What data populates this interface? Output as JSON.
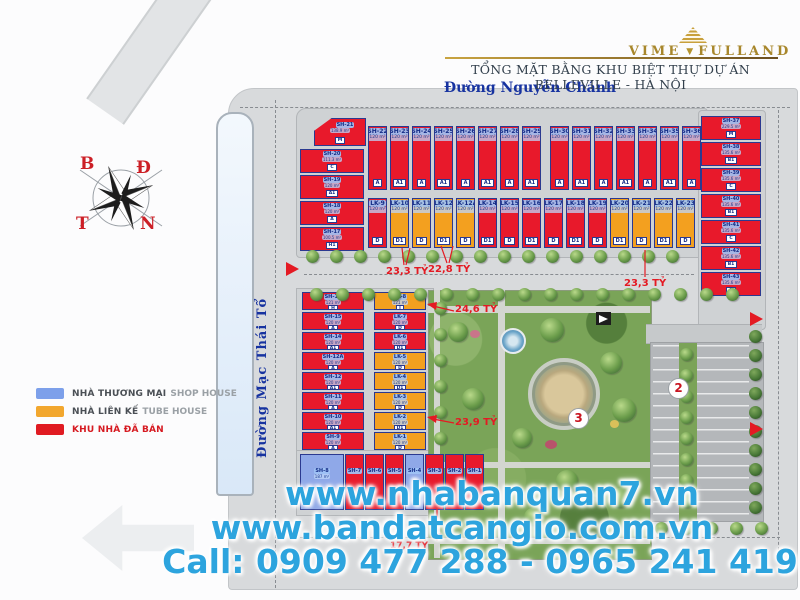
{
  "header": {
    "brand": {
      "word1": "VIME",
      "word2": "FULLAND"
    },
    "title": "TỔNG MẶT BẰNG KHU BIỆT THỰ DỰ ÁN BELLEVILLE - HÀ NỘI"
  },
  "streets": {
    "top": "Đường Nguyễn Chánh",
    "left": "Đường Mạc Thái Tổ"
  },
  "compass": {
    "n": "B",
    "e": "Đ",
    "w": "T",
    "s": "N"
  },
  "legend": {
    "items": [
      {
        "swatch": "#7da0ea",
        "vi": "NHÀ THƯƠNG MẠI",
        "en": "SHOP HOUSE"
      },
      {
        "swatch": "#f2a72e",
        "vi": "NHÀ LIÊN KẾ",
        "en": "TUBE HOUSE"
      },
      {
        "swatch": "#e01b22",
        "vi": "KHU NHÀ ĐÃ BÁN",
        "en": "",
        "color": "red"
      }
    ]
  },
  "lots": {
    "sh21": {
      "id": "SH-21",
      "area": "138.9 m²",
      "type": "M"
    },
    "top_left_column": [
      {
        "id": "SH-20",
        "area": "111.3 m²",
        "type": "C",
        "color": "red"
      },
      {
        "id": "SH-19",
        "area": "120 m²",
        "type": "A1",
        "color": "red"
      },
      {
        "id": "SH-18",
        "area": "120 m²",
        "type": "A",
        "color": "red"
      },
      {
        "id": "SH-17",
        "area": "100.5 m²",
        "type": "H1",
        "color": "red"
      }
    ],
    "top_row_a": [
      {
        "id": "SH-22",
        "area": "120 m²",
        "type": "A",
        "color": "red"
      },
      {
        "id": "SH-23",
        "area": "120 m²",
        "type": "A1",
        "color": "red"
      },
      {
        "id": "SH-24",
        "area": "120 m²",
        "type": "A",
        "color": "red"
      },
      {
        "id": "SH-25",
        "area": "120 m²",
        "type": "A1",
        "color": "red"
      },
      {
        "id": "SH-26",
        "area": "120 m²",
        "type": "A",
        "color": "red"
      },
      {
        "id": "SH-27",
        "area": "120 m²",
        "type": "A1",
        "color": "red"
      },
      {
        "id": "SH-28",
        "area": "120 m²",
        "type": "A",
        "color": "red"
      },
      {
        "id": "SH-29",
        "area": "120 m²",
        "type": "A1",
        "color": "red"
      }
    ],
    "top_row_b": [
      {
        "id": "SH-30",
        "area": "120 m²",
        "type": "A",
        "color": "red"
      },
      {
        "id": "SH-31",
        "area": "120 m²",
        "type": "A1",
        "color": "red"
      },
      {
        "id": "SH-32",
        "area": "120 m²",
        "type": "A",
        "color": "red"
      },
      {
        "id": "SH-33",
        "area": "120 m²",
        "type": "A1",
        "color": "red"
      },
      {
        "id": "SH-34",
        "area": "120 m²",
        "type": "A",
        "color": "red"
      },
      {
        "id": "SH-35",
        "area": "120 m²",
        "type": "A1",
        "color": "red"
      },
      {
        "id": "SH-36",
        "area": "120 m²",
        "type": "A",
        "color": "red"
      }
    ],
    "lk_row": [
      {
        "id": "LK-9",
        "area": "120 m²",
        "type": "D",
        "color": "red"
      },
      {
        "id": "LK-10",
        "area": "120 m²",
        "type": "D1",
        "color": "orange"
      },
      {
        "id": "LK-11",
        "area": "120 m²",
        "type": "D",
        "color": "orange"
      },
      {
        "id": "LK-12",
        "area": "120 m²",
        "type": "D1",
        "color": "orange"
      },
      {
        "id": "LK-12A",
        "area": "120 m²",
        "type": "D",
        "color": "orange"
      },
      {
        "id": "LK-14",
        "area": "120 m²",
        "type": "D1",
        "color": "red"
      },
      {
        "id": "LK-15",
        "area": "120 m²",
        "type": "D",
        "color": "red"
      },
      {
        "id": "LK-16",
        "area": "120 m²",
        "type": "D1",
        "color": "red"
      },
      {
        "id": "LK-17",
        "area": "120 m²",
        "type": "D",
        "color": "red"
      },
      {
        "id": "LK-18",
        "area": "120 m²",
        "type": "D1",
        "color": "red"
      },
      {
        "id": "LK-19",
        "area": "120 m²",
        "type": "D",
        "color": "red"
      },
      {
        "id": "LK-20",
        "area": "120 m²",
        "type": "D1",
        "color": "orange"
      },
      {
        "id": "LK-21",
        "area": "120 m²",
        "type": "D",
        "color": "orange"
      },
      {
        "id": "LK-22",
        "area": "120 m²",
        "type": "D1",
        "color": "orange"
      },
      {
        "id": "LK-23",
        "area": "120 m²",
        "type": "D",
        "color": "orange"
      }
    ],
    "right_column": [
      {
        "id": "SH-37",
        "area": "229.5 m²",
        "type": "M",
        "color": "red"
      },
      {
        "id": "SH-38",
        "area": "135.6 m²",
        "type": "B1",
        "color": "red"
      },
      {
        "id": "SH-39",
        "area": "135.6 m²",
        "type": "C",
        "color": "red"
      },
      {
        "id": "SH-40",
        "area": "135.6 m²",
        "type": "B1",
        "color": "red"
      },
      {
        "id": "SH-41",
        "area": "135.6 m²",
        "type": "C",
        "color": "red"
      },
      {
        "id": "SH-42",
        "area": "135.6 m²",
        "type": "B1",
        "color": "red"
      },
      {
        "id": "SH-43",
        "area": "135.6 m²",
        "type": "C",
        "color": "red"
      }
    ],
    "lower_sh_column": [
      {
        "id": "SH-16",
        "area": "121 m²",
        "type": "H",
        "color": "red"
      },
      {
        "id": "SH-15",
        "area": "120 m²",
        "type": "A",
        "color": "red"
      },
      {
        "id": "SH-14",
        "area": "120 m²",
        "type": "A1",
        "color": "red"
      },
      {
        "id": "SH-12A",
        "area": "120 m²",
        "type": "A",
        "color": "red"
      },
      {
        "id": "SH-12",
        "area": "120 m²",
        "type": "A1",
        "color": "red"
      },
      {
        "id": "SH-11",
        "area": "120 m²",
        "type": "A",
        "color": "red"
      },
      {
        "id": "SH-10",
        "area": "120 m²",
        "type": "A1",
        "color": "red"
      },
      {
        "id": "SH-9",
        "area": "120 m²",
        "type": "A",
        "color": "red"
      }
    ],
    "lower_lk_column": [
      {
        "id": "LK-8",
        "area": "121 m²",
        "type": "I",
        "color": "orange"
      },
      {
        "id": "LK-7",
        "area": "120 m²",
        "type": "D",
        "color": "red"
      },
      {
        "id": "LK-6",
        "area": "120 m²",
        "type": "D1",
        "color": "red"
      },
      {
        "id": "LK-5",
        "area": "120 m²",
        "type": "D",
        "color": "orange"
      },
      {
        "id": "LK-4",
        "area": "120 m²",
        "type": "D1",
        "color": "orange"
      },
      {
        "id": "LK-3",
        "area": "120 m²",
        "type": "D",
        "color": "orange"
      },
      {
        "id": "LK-2",
        "area": "120 m²",
        "type": "D1",
        "color": "orange"
      },
      {
        "id": "LK-1",
        "area": "120 m²",
        "type": "D",
        "color": "orange"
      }
    ],
    "bottom_row": [
      {
        "id": "SH-8",
        "area": "187 m²",
        "color": "blue",
        "w": 44
      },
      {
        "id": "SH-7",
        "color": "red"
      },
      {
        "id": "SH-6",
        "color": "red"
      },
      {
        "id": "SH-5",
        "color": "red"
      },
      {
        "id": "SH-4",
        "color": "blue"
      },
      {
        "id": "SH-3",
        "color": "red"
      },
      {
        "id": "SH-2",
        "color": "red"
      },
      {
        "id": "SH-1",
        "color": "red"
      }
    ]
  },
  "prices": {
    "p1": "23,3 TỶ",
    "p2": "22,8 TỶ",
    "p3": "23,3 TỶ",
    "p4": "24,6 TỶ",
    "p5": "23,9 TỶ",
    "p6": "17,7 TỶ"
  },
  "zones": {
    "parking": "2",
    "park": "3"
  },
  "watermark": {
    "line1": "www.nhabanquan7.vn",
    "line2": "www.bandatcangio.com.vn",
    "line3": "Call: 0909 477 288 - 0965 241 419"
  },
  "colors": {
    "sold": "#e8192b",
    "tube_house": "#f3a01f",
    "shop_house": "#8fa8e8",
    "watermark": "#2da4de"
  }
}
